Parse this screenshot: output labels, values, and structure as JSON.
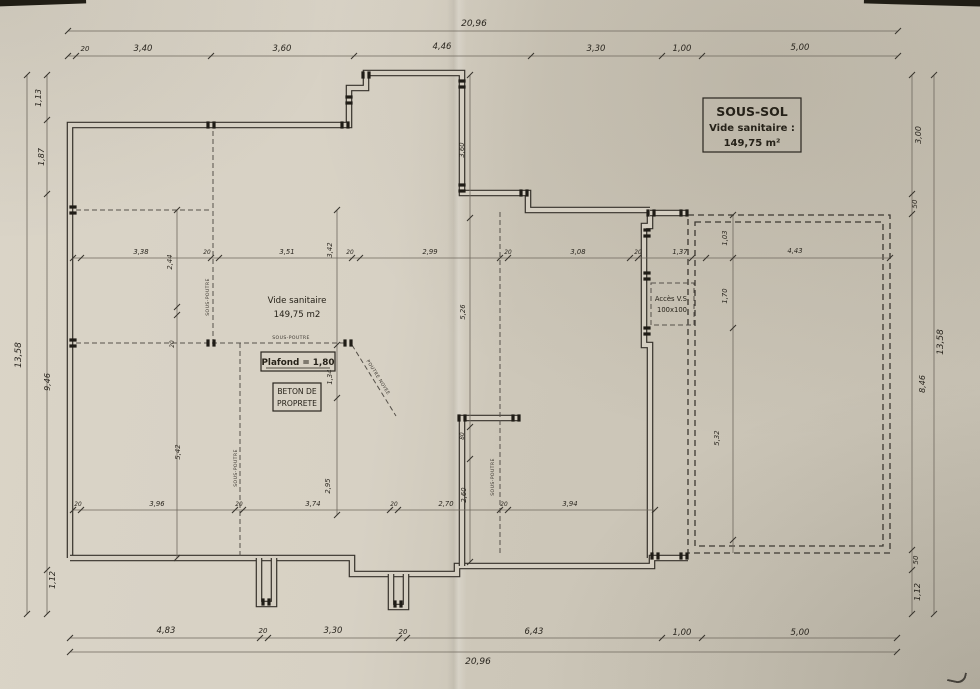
{
  "title_box": {
    "line1": "SOUS-SOL",
    "line2": "Vide sanitaire :",
    "line3": "149,75 m²"
  },
  "room_labels": {
    "vide_sanitaire_line1": "Vide sanitaire",
    "vide_sanitaire_line2": "149,75 m2",
    "plafond": "Plafond = 1,80",
    "beton_line1": "BETON DE",
    "beton_line2": "PROPRETE",
    "acces_line1": "Accès V.S.",
    "acces_line2": "100x100",
    "sous_poutre": "SOUS-POUTRE",
    "poutre_noyee": "POUTRE NOYEE"
  },
  "dimensions": {
    "top": {
      "total": "20,96",
      "chain": [
        "20",
        "3,40",
        "3,60",
        "4,46",
        "3,30",
        "1,00",
        "5,00"
      ]
    },
    "bottom": {
      "total": "20,96",
      "chain": [
        "4,83",
        "20",
        "3,30",
        "20",
        "6,43",
        "1,00",
        "5,00"
      ]
    },
    "left": {
      "total": "13,58",
      "chain": [
        "1,13",
        "1,87",
        "9,46",
        "1,12"
      ]
    },
    "right": {
      "total": "13,58",
      "chain": [
        "3,00",
        "50",
        "8,46",
        "50",
        "1,12"
      ]
    },
    "interior": {
      "upper_chain": [
        "3,38",
        "20",
        "3,51",
        "20",
        "2,99",
        "20",
        "3,08",
        "20",
        "1,37"
      ],
      "upper_right": "4,43",
      "lower_chain": [
        "20",
        "3,96",
        "20",
        "3,74",
        "20",
        "2,70",
        "20",
        "3,94"
      ],
      "left_vertical": [
        "2,44",
        "20",
        "5,42"
      ],
      "mid_vertical": [
        "3,42",
        "1,34",
        "2,95"
      ],
      "center_vertical": [
        "3,60",
        "5,26",
        "80",
        "2,60"
      ],
      "right_vertical": [
        "1,03",
        "1,70",
        "5,32"
      ]
    }
  },
  "colors": {
    "paper": "#d5cfc2",
    "ink": "#2a261f",
    "dimension_line": "#6e675d"
  }
}
